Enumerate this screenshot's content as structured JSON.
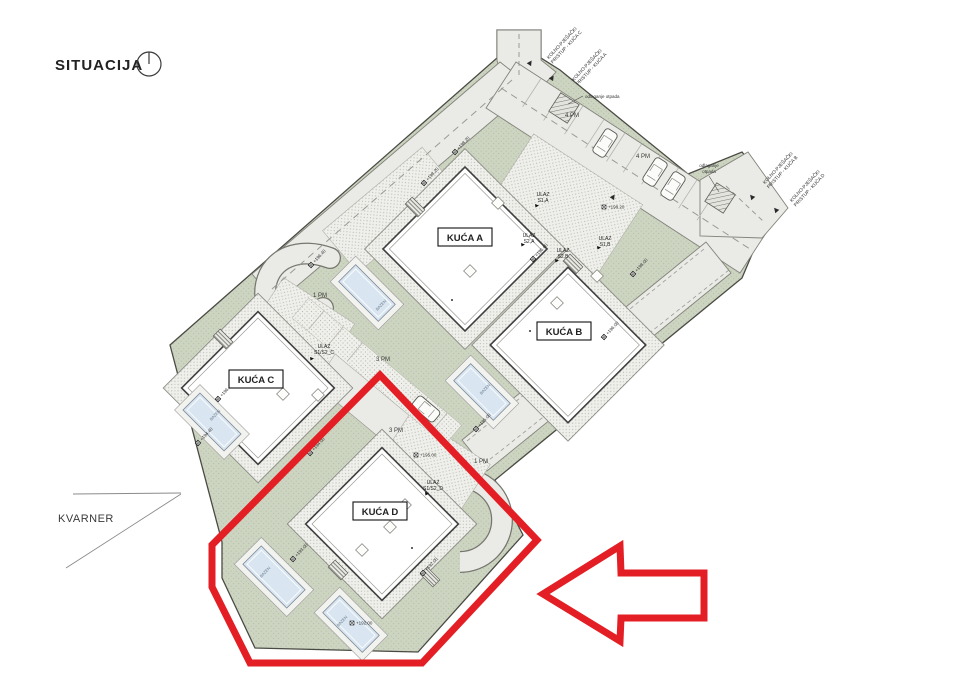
{
  "title": "SITUACIJA",
  "region_label": "KVARNER",
  "houses": [
    {
      "label": "KUĆA A"
    },
    {
      "label": "KUĆA B"
    },
    {
      "label": "KUĆA C"
    },
    {
      "label": "KUĆA D"
    }
  ],
  "access_roads": [
    {
      "line1": "KOLNO-PJEŠAČKI",
      "line2": "PRISTUP - KUĆA C"
    },
    {
      "line1": "KOLNO-PJEŠAČKI",
      "line2": "PRISTUP - KUĆA A"
    },
    {
      "line1": "KOLNO-PJEŠAČKI",
      "line2": "PRISTUP - KUĆA B"
    },
    {
      "line1": "KOLNO-PJEŠAČKI",
      "line2": "PRISTUP - KUĆA D"
    }
  ],
  "waste_label": "odlaganje otpada",
  "waste_label_line1": "odlaganje",
  "waste_label_line2": "otpada",
  "pool_label": "BAZEN",
  "parking_labels": [
    "4 PM",
    "4 PM",
    "1 PM",
    "3 PM",
    "3 PM",
    "1 PM"
  ],
  "entrances": [
    {
      "line1": "ULAZ",
      "line2": "S1,A"
    },
    {
      "line1": "ULAZ",
      "line2": "S2,A"
    },
    {
      "line1": "ULAZ",
      "line2": "S2,B"
    },
    {
      "line1": "ULAZ",
      "line2": "S1,B"
    },
    {
      "line1": "ULAZ",
      "line2": "S1/S2_C"
    },
    {
      "line1": "ULAZ",
      "line2": "S1/S2_D"
    }
  ],
  "elevation_markers": [
    "+198.20",
    "+198.20",
    "+198.20",
    "+198.00",
    "+196.00",
    "+196.00",
    "+196.40",
    "+196.40",
    "+194.40",
    "+195.00",
    "+195.00",
    "+194.00",
    "+193.00",
    "+192.00",
    "+192.00"
  ],
  "colors": {
    "highlight": "#e31e24",
    "green": "#cdd5c2",
    "road": "#eaeae7",
    "pool": "#d9e6f1"
  }
}
